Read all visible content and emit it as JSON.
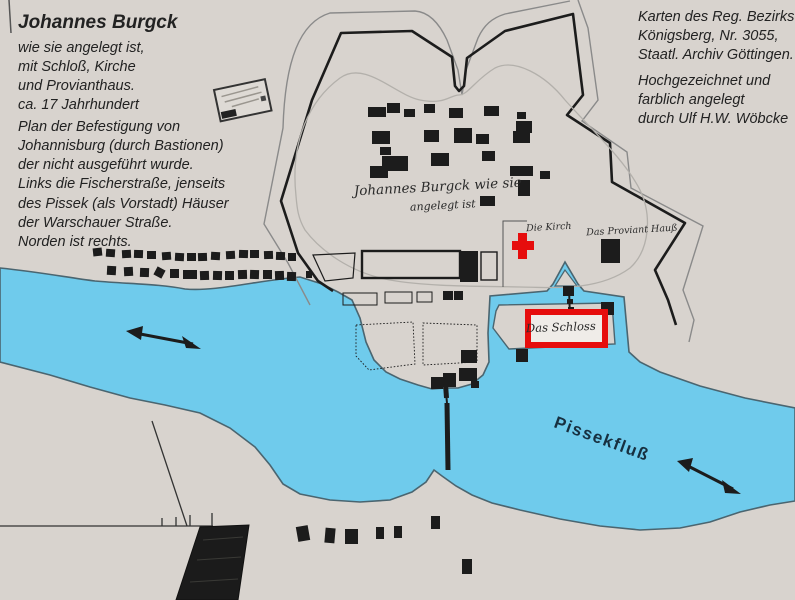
{
  "title_block": {
    "title": "Johannes Burgck",
    "lines": [
      "wie sie angelegt ist,",
      "mit Schloß, Kirche",
      "und Provianthaus.",
      "ca. 17 Jahrhundert"
    ]
  },
  "description_block": {
    "lines": [
      "Plan der Befestigung von",
      "Johannisburg (durch Bastionen)",
      "der nicht ausgeführt wurde.",
      "Links die Fischerstraße, jenseits",
      "des Pissek (als Vorstadt) Häuser",
      "der Warschauer Straße.",
      "Norden ist rechts."
    ]
  },
  "source_block": {
    "lines": [
      "Karten des Reg. Bezirks",
      "Königsberg, Nr. 3055,",
      "Staatl. Archiv Göttingen."
    ]
  },
  "credit_block": {
    "lines": [
      "Hochgezeichnet und",
      "farblich angelegt",
      "durch Ulf H.W. Wöbcke"
    ]
  },
  "colors": {
    "paper": "#d8d3ce",
    "water": "#6fcbec",
    "bank": "#4a6570",
    "ink": "#1c1c1c",
    "fort_outer_line": "#8a8a8a",
    "fort_inner_line": "#b3b0ab",
    "red": "#e60d0d",
    "text": "#222222",
    "river_label": "#173040"
  },
  "map_labels": [
    {
      "id": "fort-script-title",
      "text": "Johannes Burgck wie sie",
      "x": 438,
      "y": 191,
      "rot": -3,
      "cls": "script",
      "size": 13.5
    },
    {
      "id": "fort-script-title-2",
      "text": "angelegt ist",
      "x": 443,
      "y": 209,
      "rot": -3,
      "cls": "script",
      "size": 11
    },
    {
      "id": "kirche-label",
      "text": "Die Kirch",
      "x": 549,
      "y": 230,
      "rot": -3,
      "cls": "script",
      "size": 9.5
    },
    {
      "id": "provianthaus-label",
      "text": "Das Proviant Hauß",
      "x": 632,
      "y": 233,
      "rot": -3,
      "cls": "script",
      "size": 9.5
    },
    {
      "id": "schloss-label",
      "text": "Das Schloss",
      "x": 561,
      "y": 331,
      "rot": -2,
      "cls": "script",
      "size": 11.5
    },
    {
      "id": "pissekfluss-label",
      "text": "Pissekfluß",
      "x": 600,
      "y": 444,
      "rot": 20,
      "cls": "river",
      "size": 17
    }
  ],
  "houses": {
    "fort_houses": [
      [
        368,
        107,
        18,
        10,
        0
      ],
      [
        387,
        103,
        13,
        10,
        0
      ],
      [
        404,
        109,
        11,
        8,
        0
      ],
      [
        424,
        104,
        11,
        9,
        0
      ],
      [
        449,
        108,
        14,
        10,
        0
      ],
      [
        484,
        106,
        15,
        10,
        0
      ],
      [
        517,
        112,
        9,
        7,
        0
      ],
      [
        516,
        121,
        16,
        12,
        0
      ],
      [
        372,
        131,
        18,
        13,
        0
      ],
      [
        424,
        130,
        15,
        12,
        0
      ],
      [
        454,
        128,
        18,
        15,
        0
      ],
      [
        476,
        134,
        13,
        10,
        0
      ],
      [
        513,
        131,
        17,
        12,
        0
      ],
      [
        380,
        147,
        11,
        8,
        0
      ],
      [
        382,
        156,
        26,
        15,
        0
      ],
      [
        431,
        153,
        18,
        13,
        0
      ],
      [
        482,
        151,
        13,
        10,
        0
      ],
      [
        510,
        166,
        23,
        10,
        0
      ],
      [
        540,
        171,
        10,
        8,
        0
      ],
      [
        370,
        166,
        18,
        12,
        0
      ],
      [
        518,
        180,
        12,
        16,
        0
      ],
      [
        480,
        196,
        15,
        10,
        0
      ]
    ],
    "fischerstrasse_row1": [
      [
        93,
        248,
        9,
        8,
        -6
      ],
      [
        106,
        249,
        9,
        8,
        4
      ],
      [
        122,
        250,
        9,
        8,
        -3
      ],
      [
        134,
        250,
        9,
        8,
        2
      ],
      [
        147,
        251,
        9,
        8,
        0
      ],
      [
        162,
        252,
        9,
        8,
        -4
      ],
      [
        175,
        253,
        9,
        8,
        3
      ],
      [
        187,
        253,
        9,
        8,
        0
      ],
      [
        198,
        253,
        9,
        8,
        -2
      ],
      [
        211,
        252,
        9,
        8,
        3
      ],
      [
        226,
        251,
        9,
        8,
        -3
      ],
      [
        239,
        250,
        9,
        8,
        2
      ],
      [
        250,
        250,
        9,
        8,
        0
      ],
      [
        264,
        251,
        9,
        8,
        -2
      ],
      [
        276,
        252,
        9,
        8,
        2
      ],
      [
        288,
        253,
        8,
        8,
        0
      ]
    ],
    "fischerstrasse_row2": [
      [
        107,
        266,
        9,
        9,
        3
      ],
      [
        124,
        267,
        9,
        9,
        -3
      ],
      [
        140,
        268,
        9,
        9,
        2
      ],
      [
        155,
        268,
        9,
        9,
        28
      ],
      [
        170,
        269,
        9,
        9,
        0
      ],
      [
        183,
        270,
        14,
        9,
        0
      ],
      [
        200,
        271,
        9,
        9,
        -2
      ],
      [
        213,
        271,
        9,
        9,
        2
      ],
      [
        225,
        271,
        9,
        9,
        0
      ],
      [
        238,
        270,
        9,
        9,
        -2
      ],
      [
        250,
        270,
        9,
        9,
        2
      ],
      [
        263,
        270,
        9,
        9,
        0
      ],
      [
        275,
        271,
        9,
        9,
        -2
      ],
      [
        287,
        272,
        9,
        9,
        2
      ]
    ],
    "warschauer_houses": [
      [
        297,
        526,
        12,
        15,
        -10
      ],
      [
        325,
        528,
        10,
        15,
        5
      ],
      [
        345,
        529,
        13,
        15,
        0
      ],
      [
        376,
        527,
        8,
        12,
        0
      ],
      [
        394,
        526,
        8,
        12,
        0
      ],
      [
        431,
        516,
        9,
        13,
        0
      ],
      [
        462,
        559,
        10,
        15,
        0
      ]
    ],
    "misc_buildings": [
      [
        306,
        271,
        6,
        7,
        0
      ],
      [
        443,
        291,
        10,
        9,
        0
      ],
      [
        454,
        291,
        9,
        9,
        0
      ],
      [
        460,
        251,
        18,
        31,
        0
      ],
      [
        461,
        350,
        16,
        13,
        0
      ],
      [
        459,
        368,
        18,
        13,
        0
      ],
      [
        443,
        373,
        13,
        14,
        0
      ],
      [
        431,
        377,
        12,
        12,
        0
      ],
      [
        471,
        381,
        8,
        7,
        0
      ],
      [
        601,
        239,
        19,
        24,
        0
      ],
      [
        601,
        302,
        13,
        13,
        0
      ],
      [
        594,
        329,
        9,
        8,
        0
      ],
      [
        516,
        349,
        12,
        13,
        0
      ],
      [
        563,
        286,
        11,
        10,
        0
      ],
      [
        567,
        299,
        6,
        5,
        0
      ],
      [
        568,
        307,
        6,
        5,
        0
      ],
      [
        445,
        381,
        7,
        6,
        0
      ]
    ]
  }
}
